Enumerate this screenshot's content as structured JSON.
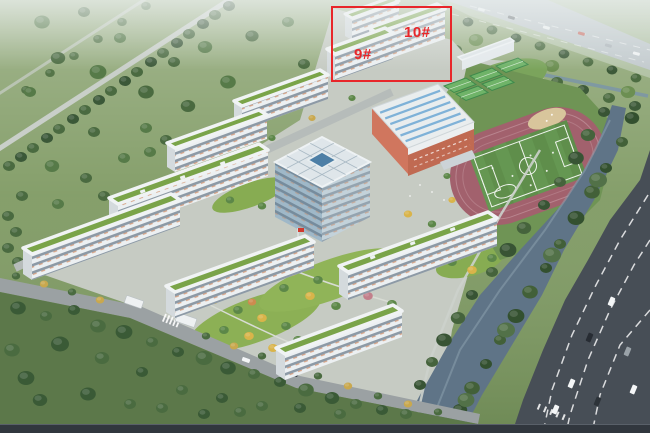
{
  "annotation": {
    "color": "#e8262a",
    "labels": [
      {
        "text": "9#"
      },
      {
        "text": "10#"
      }
    ]
  },
  "palette": {
    "meadow": "#7f9a63",
    "campus_paving": "#c6cbc3",
    "green_roof": "#7aa449",
    "building_wall": "#ecf0f2",
    "track_surface": "#a2616d",
    "field_green": "#5f8e4b",
    "sand": "#d8c59c",
    "river_water": "#5f7487",
    "east_road": "#474e56",
    "south_road": "#9ba1a3",
    "gym_wall": "#c06a52",
    "gym_roof_strip": "#7fb2d8",
    "court_green": "#6fb368",
    "main_glass": "#9fb8c8",
    "courtyard_pool": "#4d7fa6"
  }
}
